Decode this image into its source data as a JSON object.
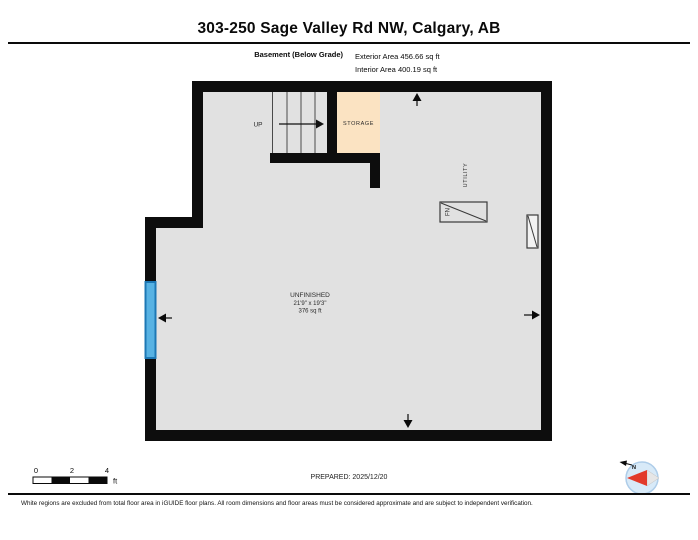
{
  "header": {
    "title": "303-250 Sage Valley Rd NW, Calgary, AB",
    "floor_label": "Basement (Below Grade)",
    "exterior_area": "Exterior Area 456.66 sq ft",
    "interior_area": "Interior Area 400.19 sq ft"
  },
  "rooms": {
    "stairs_label": "UP",
    "storage_label": "STORAGE",
    "utility_label": "UTILITY",
    "furnace_label": "FN",
    "unfinished": {
      "label": "UNFINISHED",
      "dimensions": "21'9\" x 19'3\"",
      "area": "376 sq ft"
    }
  },
  "scale_bar": {
    "ticks": [
      "0",
      "2",
      "4"
    ],
    "unit": "ft"
  },
  "compass": {
    "north_label": "N"
  },
  "footer": {
    "prepared": "PREPARED: 2025/12/20",
    "disclaimer": "White regions are excluded from total floor area in iGUIDE floor plans. All room dimensions and floor areas must be considered approximate and are subject to independent verification."
  },
  "colors": {
    "wall": "#0d0d0d",
    "floor": "#e1e1e1",
    "storage": "#fbe3c2",
    "window": "#57b2e3",
    "window_border": "#1d78b5",
    "compass_circle": "#d8eaf8",
    "compass_ring": "#aecde9",
    "compass_needle_north": "#e23a2a",
    "compass_needle_south": "#e6e6e6"
  }
}
